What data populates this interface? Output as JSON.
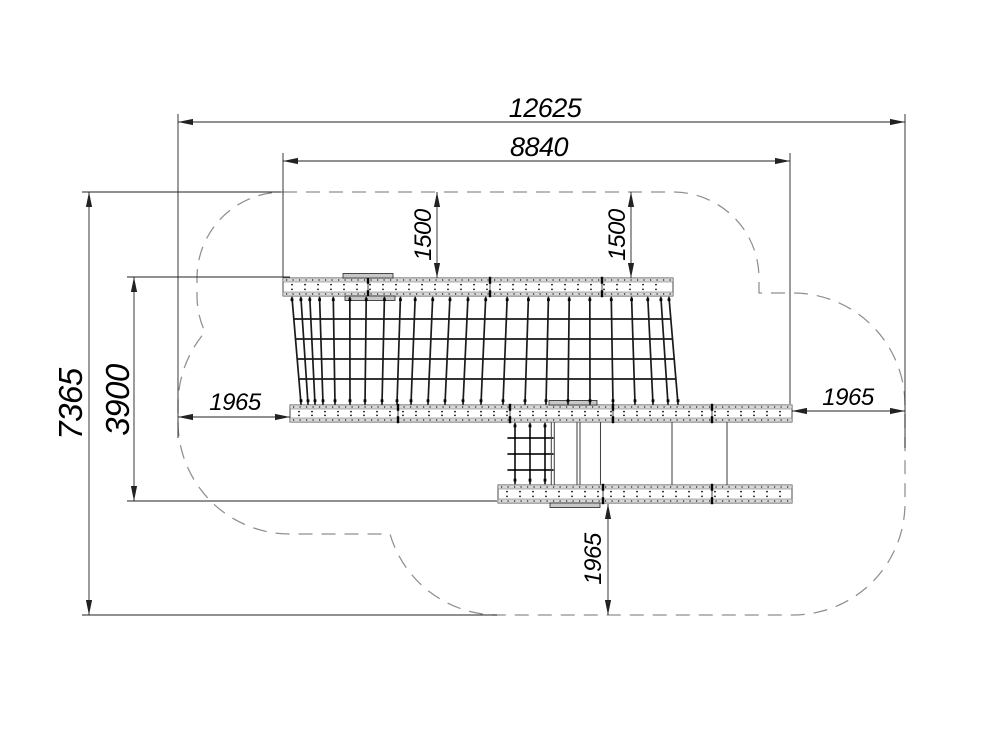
{
  "dimensions": {
    "safety_zone_length": "12625",
    "equipment_length": "8840",
    "net_clearance_left": "1500",
    "net_clearance_right": "1500",
    "side_clearance_left": "1965",
    "side_clearance_right": "1965",
    "bottom_clearance": "1965",
    "safety_zone_width": "7365",
    "equipment_width": "3900"
  },
  "colors": {
    "line": "#1a1a1a",
    "dimension": "#222222",
    "boundary_dash": "#8f8f8f",
    "plank_fill": "#d8d8d8",
    "plate_fill": "#c8c8c8",
    "background": "#ffffff"
  }
}
